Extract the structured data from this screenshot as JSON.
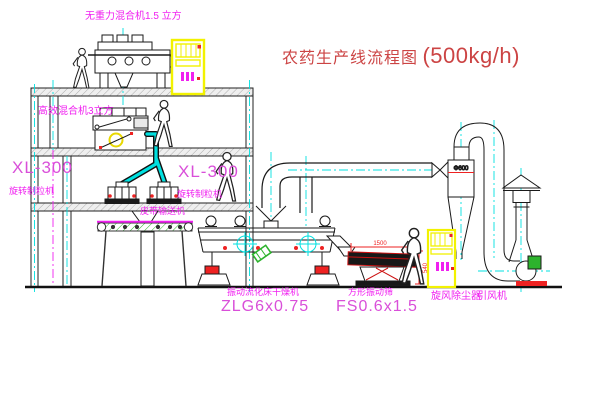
{
  "diagram": {
    "title": "农药生产线流程图",
    "title_capacity": "(500kg/h)"
  },
  "labels": {
    "gravity_free_mixer": "无重力混合机1.5 立方",
    "high_mixer": "高效混合机3立方",
    "granulator_model_left": "XL-300",
    "granulator_name_left": "旋转制粒机",
    "granulator_model_mid": "XL-300",
    "granulator_name_mid": "旋转制粒机",
    "belt_conveyor": "皮带输送机",
    "dryer_name": "振动流化床干燥机",
    "dryer_model": "ZLG6x0.75",
    "sieve_name": "方形振动筛",
    "sieve_model": "FS0.6x1.5",
    "cyclone": "旋风除尘器",
    "fan": "引风机"
  },
  "dimensions": {
    "sieve_length": "1500",
    "sieve_height": "540",
    "cyclone_diameter": "Φ600"
  },
  "colors": {
    "label_magenta": "#f020f0",
    "model_magenta": "#d94fd9",
    "title_red": "#cc4444",
    "dimension_red": "#ee2222",
    "centerline_cyan": "#00e0e0",
    "cabinet_yellow": "#f2f200",
    "machine_black": "#1a1a1a",
    "accent_green": "#2db32d"
  }
}
